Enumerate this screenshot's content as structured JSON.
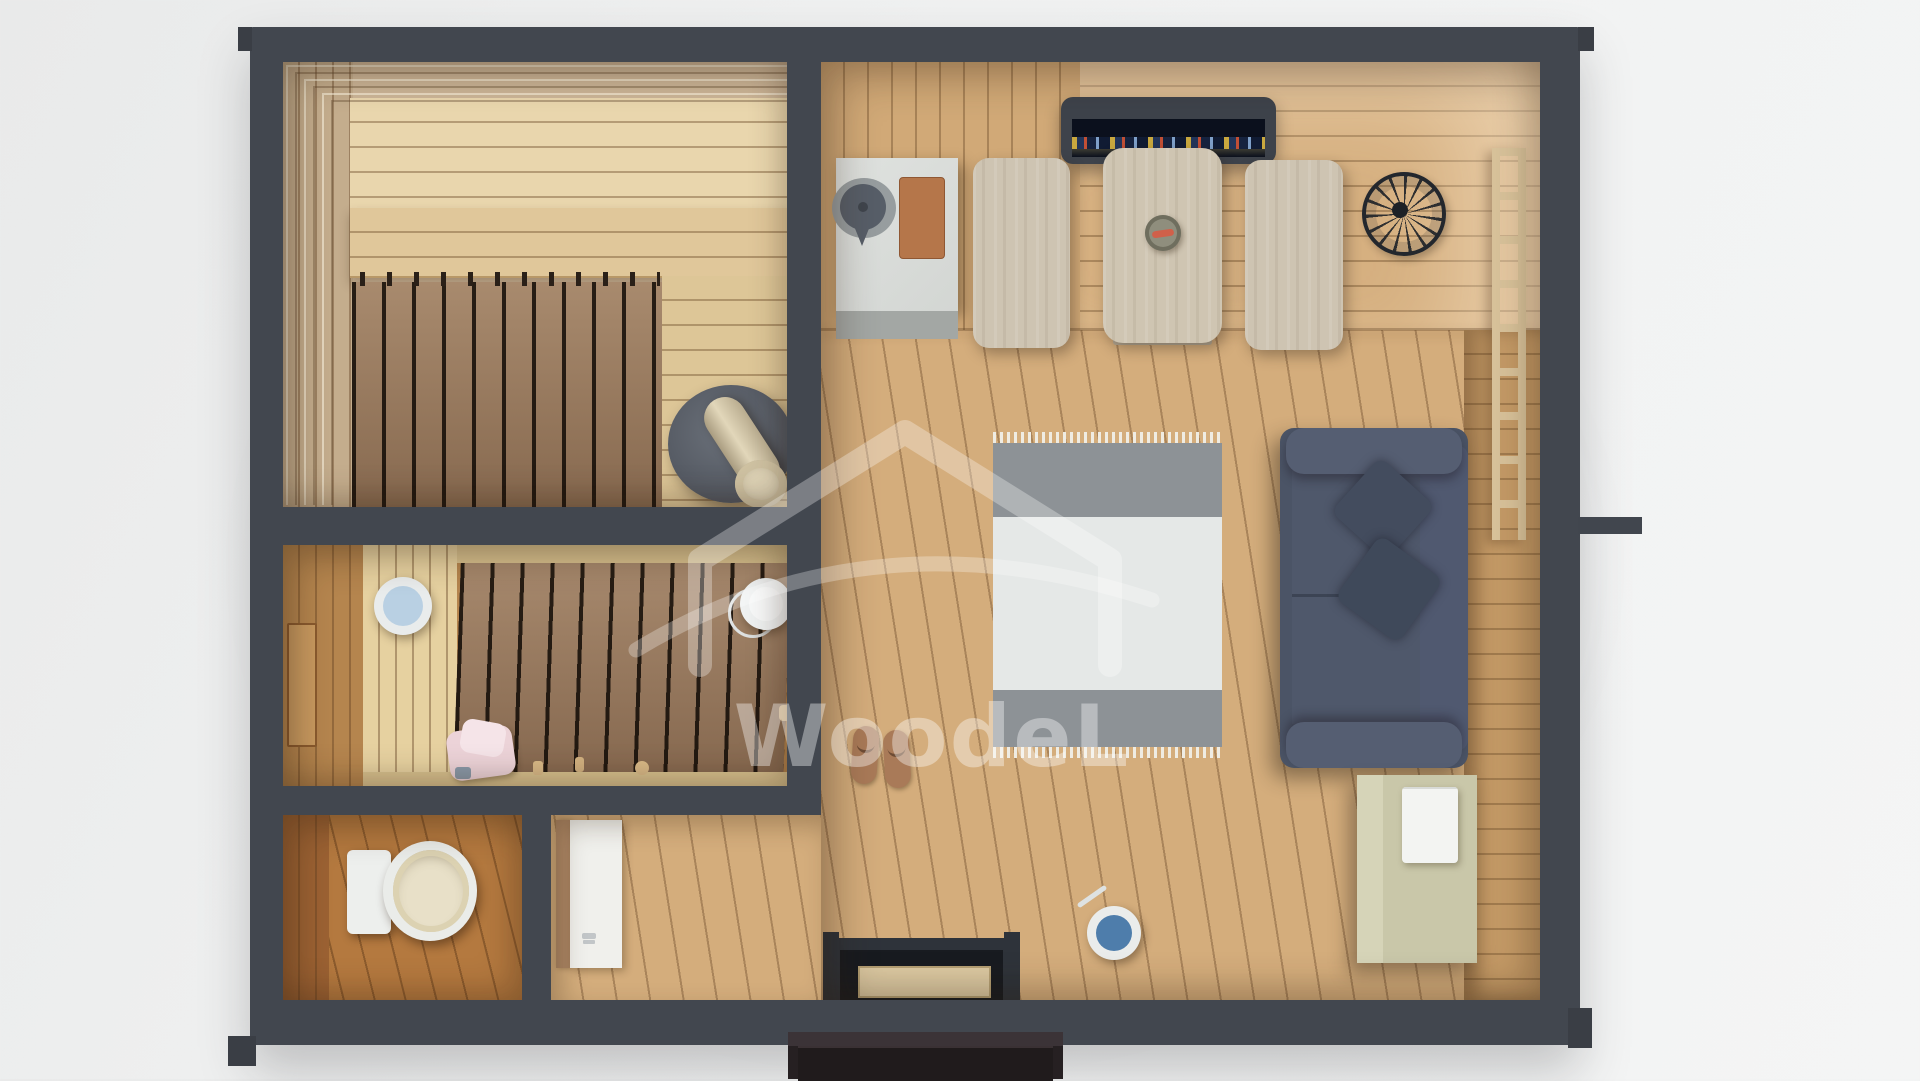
{
  "scene": {
    "title": "3D top-down floor plan render of a wooden sauna cabin",
    "watermark": {
      "text": "WoodeL",
      "logo_icon": "house-outline-watermark-icon"
    },
    "palette": {
      "background": "#eff0f0",
      "wall_dark_gray": "#42474f",
      "floor_light_pine": "#d4ad7c",
      "floor_dark_duckboard": "#9a7a5e",
      "sauna_bench_pale": "#e9d6ad",
      "sofa_slate_blue": "#4b5466",
      "rug_gray_band": "#8d9296",
      "rug_white_field": "#e5e8e7",
      "cabinet_sage": "#c9c7a9",
      "stove_gray": "#5b6069",
      "chimney_beige": "#e0d5b8",
      "bucket_blue": "#4e7dab",
      "basin_light_blue": "#b9d0e3",
      "towel_pink": "#ecd3d8",
      "counter_concrete": "#d9dcd9",
      "tv_screen_night": "#0b101d",
      "entry_steps_dark": "#262022",
      "toilet_floor_orange": "#b4793f"
    },
    "rooms": [
      {
        "name": "sauna",
        "objects": [
          "tiered-benches",
          "duckboard-floor",
          "sauna-stove",
          "stove-chimney"
        ]
      },
      {
        "name": "washroom",
        "objects": [
          "duckboard-floor",
          "blue-basin",
          "white-pail",
          "pink-towel",
          "wooden-accessories",
          "wall-niche"
        ]
      },
      {
        "name": "toilet-room",
        "objects": [
          "toilet"
        ]
      },
      {
        "name": "hallway",
        "objects": [
          "open-door-leaf",
          "entrance-door",
          "entry-steps"
        ]
      },
      {
        "name": "main-room",
        "objects": [
          "kitchen-counter",
          "kettle",
          "cutting-board",
          "tv",
          "bench",
          "dining-table",
          "plate",
          "bench",
          "wire-basket",
          "wall-ladder",
          "area-rug",
          "sofa",
          "pillows",
          "sage-cabinet",
          "white-towel",
          "blue-bucket",
          "flip-flops"
        ]
      }
    ]
  }
}
